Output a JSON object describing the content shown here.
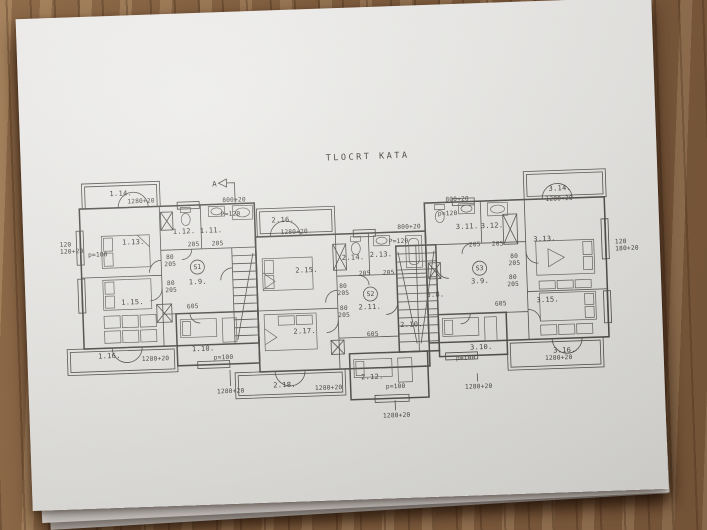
{
  "title": "TLOCRT KATA",
  "section_marker": {
    "letter": "A"
  },
  "stamps": [
    {
      "text": "S1",
      "x": 173,
      "y": 256
    },
    {
      "text": "S2",
      "x": 345,
      "y": 289
    },
    {
      "text": "S3",
      "x": 455,
      "y": 267
    }
  ],
  "room_labels": [
    {
      "text": "1.14.",
      "x": 99,
      "y": 180
    },
    {
      "text": "1.13.",
      "x": 110,
      "y": 229
    },
    {
      "text": "1.12.",
      "x": 161,
      "y": 220
    },
    {
      "text": "1.11.",
      "x": 188,
      "y": 220
    },
    {
      "text": "1.9.",
      "x": 173,
      "y": 271
    },
    {
      "text": "1.15.",
      "x": 107,
      "y": 289
    },
    {
      "text": "1.10.",
      "x": 176,
      "y": 338
    },
    {
      "text": "1.16.",
      "x": 82,
      "y": 342
    },
    {
      "text": "2.16.",
      "x": 260,
      "y": 212
    },
    {
      "text": "2.15.",
      "x": 282,
      "y": 263
    },
    {
      "text": "2.14.",
      "x": 329,
      "y": 252
    },
    {
      "text": "2.13.",
      "x": 357,
      "y": 250
    },
    {
      "text": "2.11.",
      "x": 344,
      "y": 302
    },
    {
      "text": "2.10.",
      "x": 385,
      "y": 321
    },
    {
      "text": "2.17.",
      "x": 278,
      "y": 324
    },
    {
      "text": "2.12.",
      "x": 344,
      "y": 372
    },
    {
      "text": "2.18.",
      "x": 256,
      "y": 377
    },
    {
      "text": "3.14.",
      "x": 538,
      "y": 190
    },
    {
      "text": "3.13.",
      "x": 521,
      "y": 240
    },
    {
      "text": "3.11.",
      "x": 444,
      "y": 225
    },
    {
      "text": "3.12.",
      "x": 469,
      "y": 225
    },
    {
      "text": "3.9.",
      "x": 455,
      "y": 280
    },
    {
      "text": "3.8.",
      "x": 410,
      "y": 292
    },
    {
      "text": "3.15.",
      "x": 522,
      "y": 301
    },
    {
      "text": "3.10.",
      "x": 454,
      "y": 346
    },
    {
      "text": "3.16.",
      "x": 537,
      "y": 352
    }
  ],
  "dim_labels": [
    {
      "text": "1280+20",
      "x": 119,
      "y": 188
    },
    {
      "text": "800+20",
      "x": 212,
      "y": 190
    },
    {
      "text": "P=120",
      "x": 208,
      "y": 204
    },
    {
      "text": "120",
      "x": 42,
      "y": 229
    },
    {
      "text": "120+20",
      "x": 48,
      "y": 236
    },
    {
      "text": "p=100",
      "x": 74,
      "y": 240
    },
    {
      "text": "205",
      "x": 170,
      "y": 233
    },
    {
      "text": "205",
      "x": 194,
      "y": 233
    },
    {
      "text": "80",
      "x": 146,
      "y": 245
    },
    {
      "text": "205",
      "x": 146,
      "y": 252
    },
    {
      "text": "80",
      "x": 146,
      "y": 271
    },
    {
      "text": "205",
      "x": 146,
      "y": 278
    },
    {
      "text": "605",
      "x": 167,
      "y": 295
    },
    {
      "text": "p=100",
      "x": 196,
      "y": 347
    },
    {
      "text": "1280+20",
      "x": 128,
      "y": 346
    },
    {
      "text": "1280+20",
      "x": 202,
      "y": 381
    },
    {
      "text": "1280+20",
      "x": 271,
      "y": 224
    },
    {
      "text": "800+20",
      "x": 386,
      "y": 223
    },
    {
      "text": "P=120",
      "x": 375,
      "y": 237
    },
    {
      "text": "205",
      "x": 340,
      "y": 268
    },
    {
      "text": "205",
      "x": 364,
      "y": 268
    },
    {
      "text": "80",
      "x": 318,
      "y": 280
    },
    {
      "text": "205",
      "x": 318,
      "y": 287
    },
    {
      "text": "80",
      "x": 318,
      "y": 302
    },
    {
      "text": "205",
      "x": 318,
      "y": 309
    },
    {
      "text": "605",
      "x": 346,
      "y": 329
    },
    {
      "text": "p=100",
      "x": 367,
      "y": 382
    },
    {
      "text": "1280+20",
      "x": 300,
      "y": 381
    },
    {
      "text": "1280+20",
      "x": 367,
      "y": 411
    },
    {
      "text": "1280+20",
      "x": 450,
      "y": 385
    },
    {
      "text": "800+20",
      "x": 435,
      "y": 197
    },
    {
      "text": "p=120",
      "x": 425,
      "y": 211
    },
    {
      "text": "205",
      "x": 451,
      "y": 243
    },
    {
      "text": "205",
      "x": 474,
      "y": 243
    },
    {
      "text": "80",
      "x": 490,
      "y": 256
    },
    {
      "text": "205",
      "x": 490,
      "y": 263
    },
    {
      "text": "80",
      "x": 488,
      "y": 277
    },
    {
      "text": "205",
      "x": 488,
      "y": 284
    },
    {
      "text": "1280+20",
      "x": 537,
      "y": 200
    },
    {
      "text": "120",
      "x": 597,
      "y": 245
    },
    {
      "text": "180+20",
      "x": 603,
      "y": 252
    },
    {
      "text": "605",
      "x": 475,
      "y": 303
    },
    {
      "text": "p=100",
      "x": 438,
      "y": 356
    },
    {
      "text": "1280+20",
      "x": 531,
      "y": 359
    }
  ]
}
